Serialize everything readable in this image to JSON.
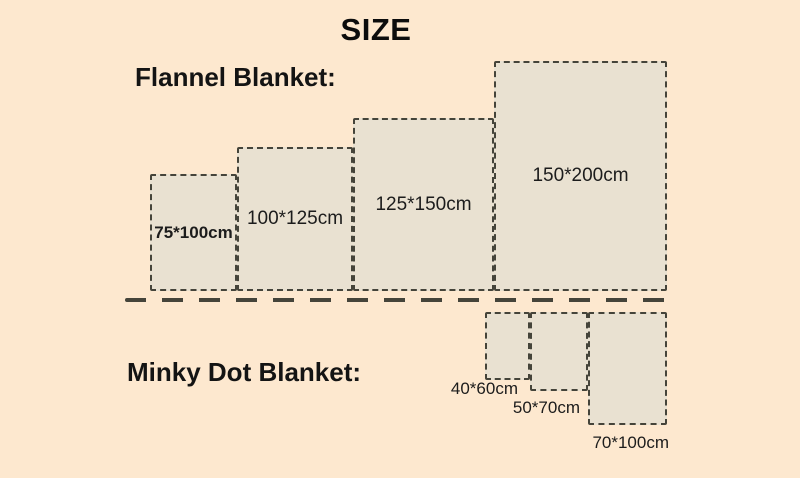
{
  "title": "SIZE",
  "colors": {
    "background": "#fde8cf",
    "rect_fill": "#e9e1d1",
    "dash_border": "#45443a",
    "text": "#141414"
  },
  "flannel": {
    "label": "Flannel Blanket:",
    "sizes": [
      {
        "label": "75*100cm",
        "width_cm": 75,
        "height_cm": 100
      },
      {
        "label": "100*125cm",
        "width_cm": 100,
        "height_cm": 125
      },
      {
        "label": "125*150cm",
        "width_cm": 125,
        "height_cm": 150
      },
      {
        "label": "150*200cm",
        "width_cm": 150,
        "height_cm": 200
      }
    ]
  },
  "minky": {
    "label": "Minky Dot Blanket:",
    "sizes": [
      {
        "label": "40*60cm",
        "width_cm": 40,
        "height_cm": 60
      },
      {
        "label": "50*70cm",
        "width_cm": 50,
        "height_cm": 70
      },
      {
        "label": "70*100cm",
        "width_cm": 70,
        "height_cm": 100
      }
    ]
  }
}
